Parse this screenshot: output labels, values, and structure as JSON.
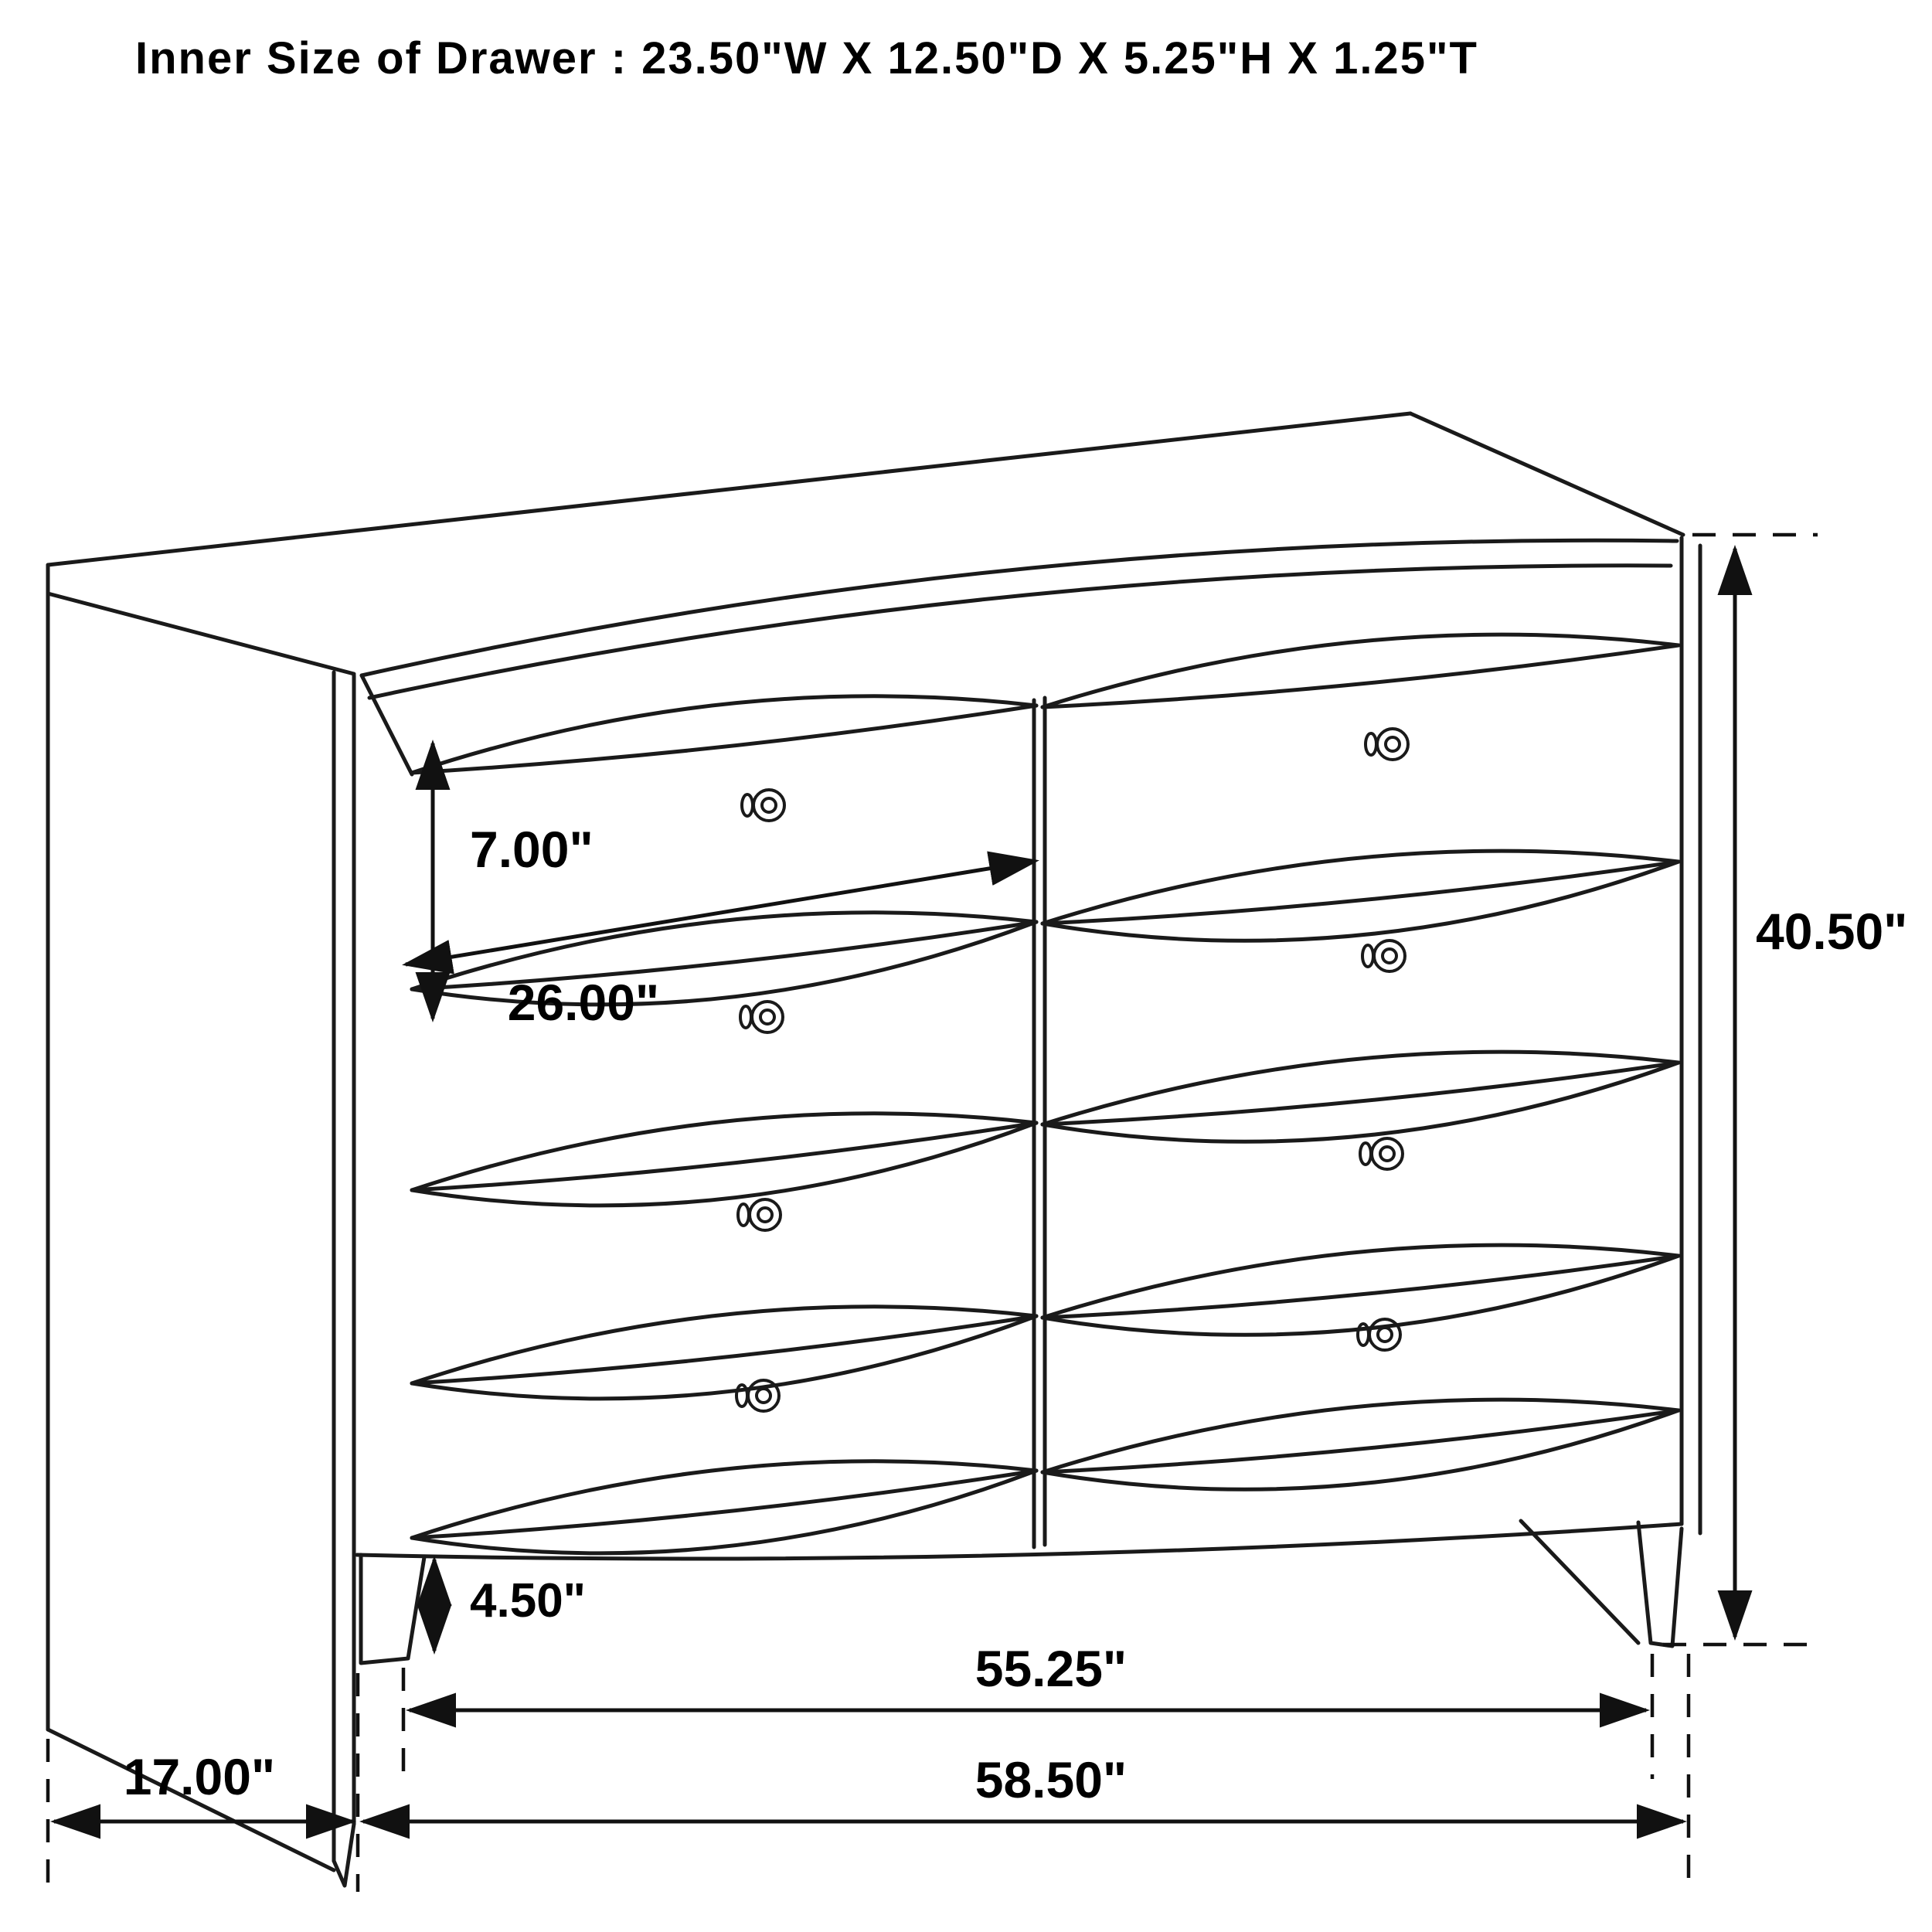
{
  "title": "Inner Size of Drawer : 23.50\"W X 12.50\"D X 5.25\"H X 1.25\"T",
  "diagram_type": "furniture-dimension-drawing",
  "subject": "6-drawer dresser (two columns of four drawers, pillow fronts, round knobs)",
  "dimensions": {
    "drawer_face_height": "7.00\"",
    "drawer_width": "26.00\"",
    "overall_height": "40.50\"",
    "foot_height": "4.50\"",
    "front_width_between_legs": "55.25\"",
    "side_depth": "17.00\"",
    "overall_width": "58.50\""
  },
  "colors": {
    "line": "#1a1a1a",
    "background": "#ffffff",
    "text": "#000000"
  }
}
